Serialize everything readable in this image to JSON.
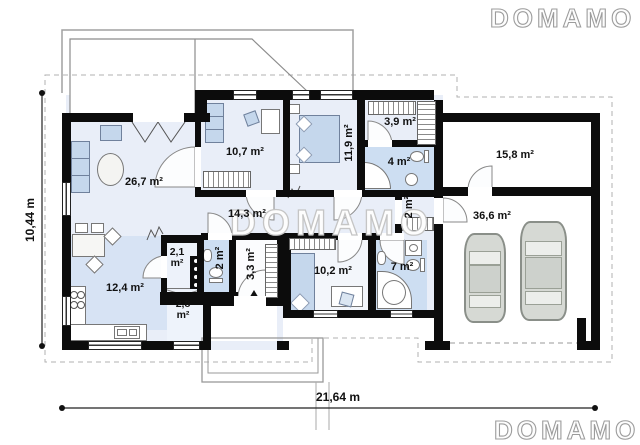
{
  "watermarks": {
    "center": "DOMAMO",
    "top_right": "DOMAMO",
    "bottom_right": "DOMAMO"
  },
  "dimensions": {
    "height_label": "10,44 m",
    "width_label": "21,64 m"
  },
  "rooms": {
    "living_room": "26,7 m²",
    "room_10_7": "10,7 m²",
    "bedroom_11_9": "11,9 m²",
    "wardrobe_3_9": "3,9 m²",
    "bathroom_4": "4 m²",
    "storage_15_8": "15,8 m²",
    "hall_14_3": "14,3 m²",
    "wc_2": "2 m²",
    "corridor_2": "2 m²",
    "garage_36_6": "36,6 m²",
    "kitchen_12_4": "12,4 m²",
    "pantry_2_1": "2,1 m²",
    "entry_3_3": "3,3 m²",
    "room_10_2": "10,2 m²",
    "bathroom_7": "7 m²",
    "utility_2_8": "2,8 m²"
  },
  "colors": {
    "wall": "#0c0c0c",
    "floor_base": "#e9eef8",
    "floor_kitchen": "#d7e3f4",
    "floor_bath": "#cddef2",
    "furniture": "#c5d7ec",
    "watermark_outline": "#c5c5c5"
  }
}
